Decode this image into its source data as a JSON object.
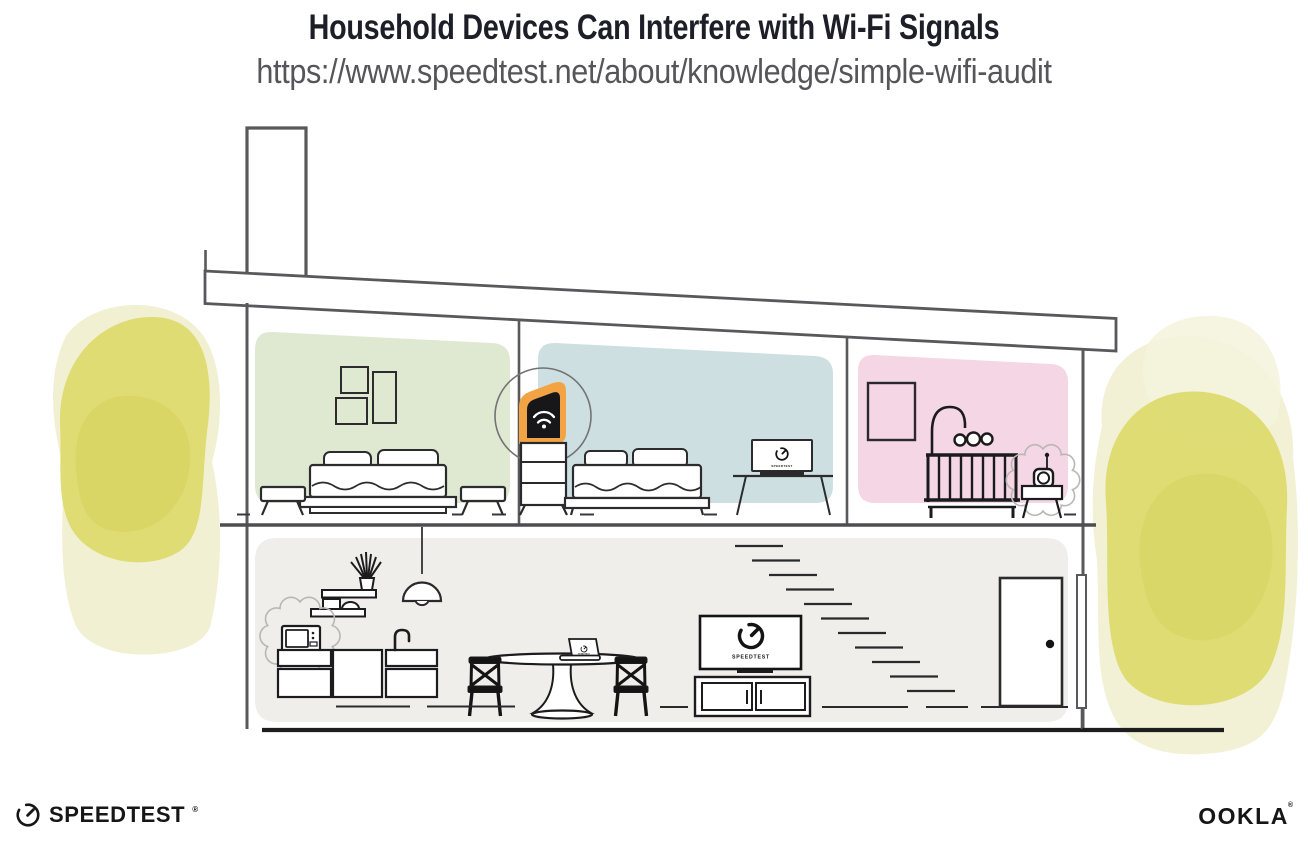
{
  "header": {
    "title": "Household Devices Can Interfere with Wi-Fi Signals",
    "url": "https://www.speedtest.net/about/knowledge/simple-wifi-audit"
  },
  "colors": {
    "bedroom_green": "#dfe9d2",
    "bedroom_blue": "#cedfe2",
    "nursery_pink": "#f4d6e5",
    "living_gray": "#f0eeeb",
    "router_orange": "#f2a444",
    "foliage_yellow": "#dbd968",
    "foliage_halo": "#edebc3"
  },
  "screens": {
    "bedroom_monitor_label": "SPEEDTEST",
    "dining_laptop_label": "SPEEDTEST",
    "living_tv_label": "SPEEDTEST"
  },
  "footer": {
    "speedtest_wordmark": "SPEEDTEST",
    "speedtest_trademark": "®",
    "ookla_wordmark": "OOKLA",
    "ookla_trademark": "®"
  }
}
